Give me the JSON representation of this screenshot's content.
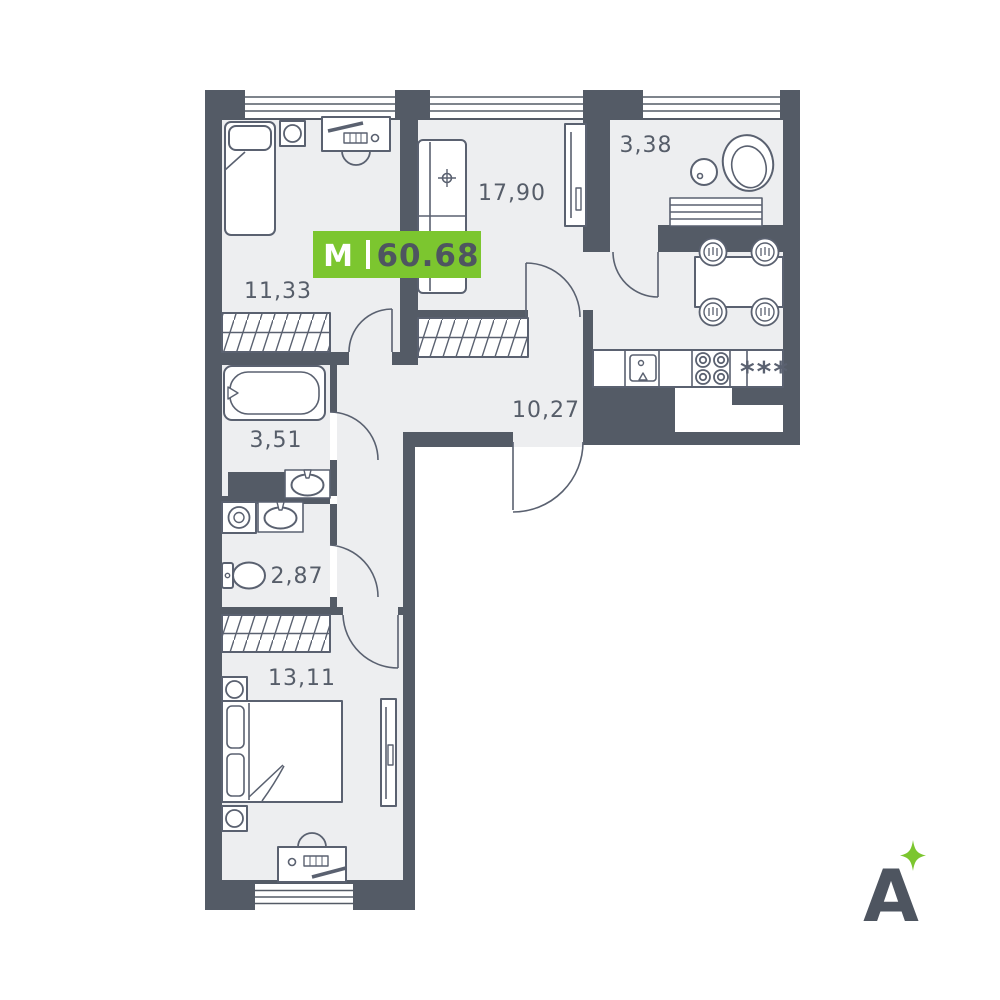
{
  "palette": {
    "wall": "#545B66",
    "floor": "#EDEEF0",
    "line": "#5A6170",
    "accent_green": "#7CC62F",
    "badge_number": "#4E5560",
    "background": "#FFFFFF"
  },
  "badge": {
    "type": "M",
    "area": "60.68"
  },
  "rooms": {
    "bedroom_top": {
      "label": "11,33"
    },
    "living": {
      "label": "17,90"
    },
    "bathroom_top": {
      "label": "3,38"
    },
    "hallway": {
      "label": "10,27"
    },
    "bathroom_mid": {
      "label": "3,51"
    },
    "wc": {
      "label": "2,87"
    },
    "bedroom_bottom": {
      "label": "13,11"
    }
  },
  "kitchen": {
    "fridge_symbol": "***"
  },
  "logo": {
    "letter": "A"
  }
}
